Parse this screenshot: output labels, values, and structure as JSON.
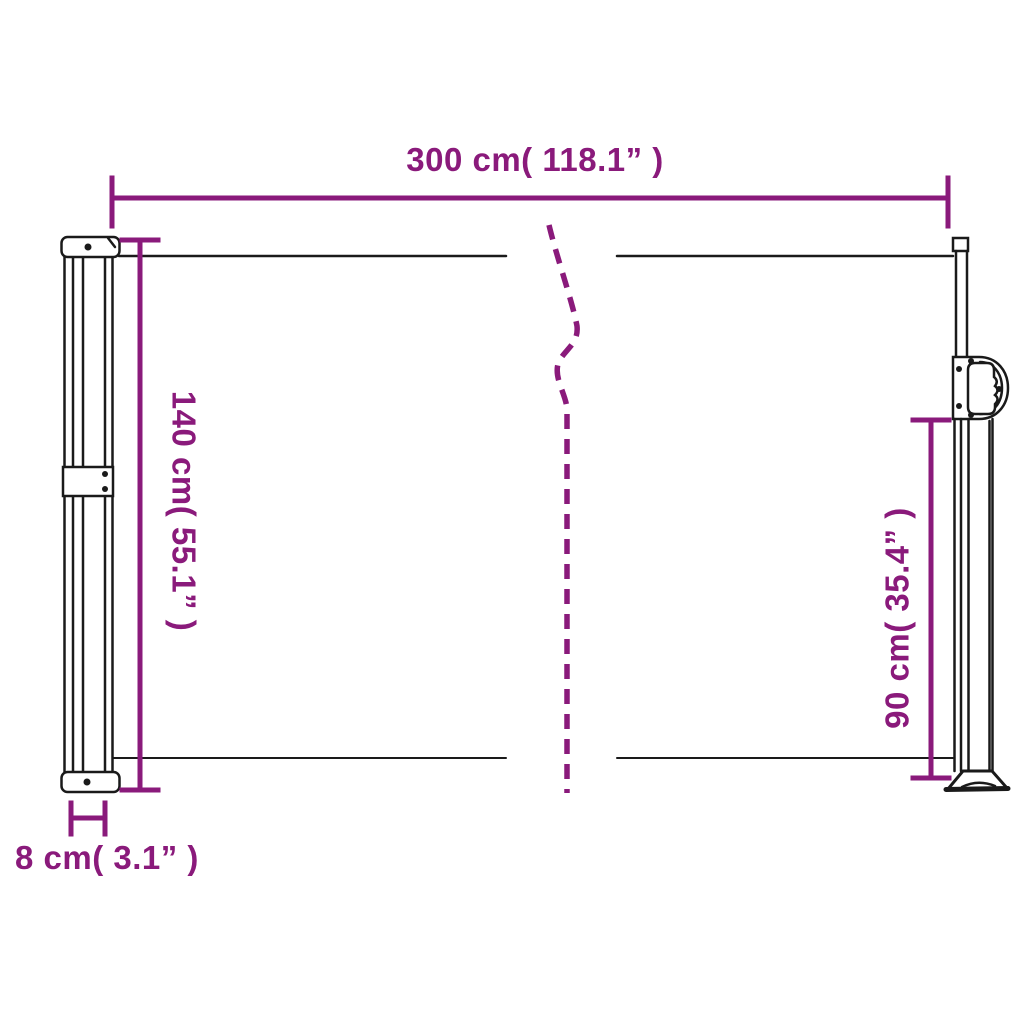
{
  "diagram": {
    "subject": "retractable-side-awning-dimension-diagram",
    "colors": {
      "dimension_magenta": "#8A1A7B",
      "outline_black": "#1A1A1A",
      "background": "#FFFFFF"
    },
    "dimensions": {
      "width": {
        "label": "300 cm( 118.1” )",
        "value_cm": 300,
        "value_inch": 118.1
      },
      "height_left": {
        "label": "140 cm( 55.1” )",
        "value_cm": 140,
        "value_inch": 55.1
      },
      "height_right": {
        "label": "90 cm( 35.4” )",
        "value_cm": 90,
        "value_inch": 35.4
      },
      "cassette_depth": {
        "label": "8 cm( 3.1” )",
        "value_cm": 8,
        "value_inch": 3.1
      }
    }
  }
}
